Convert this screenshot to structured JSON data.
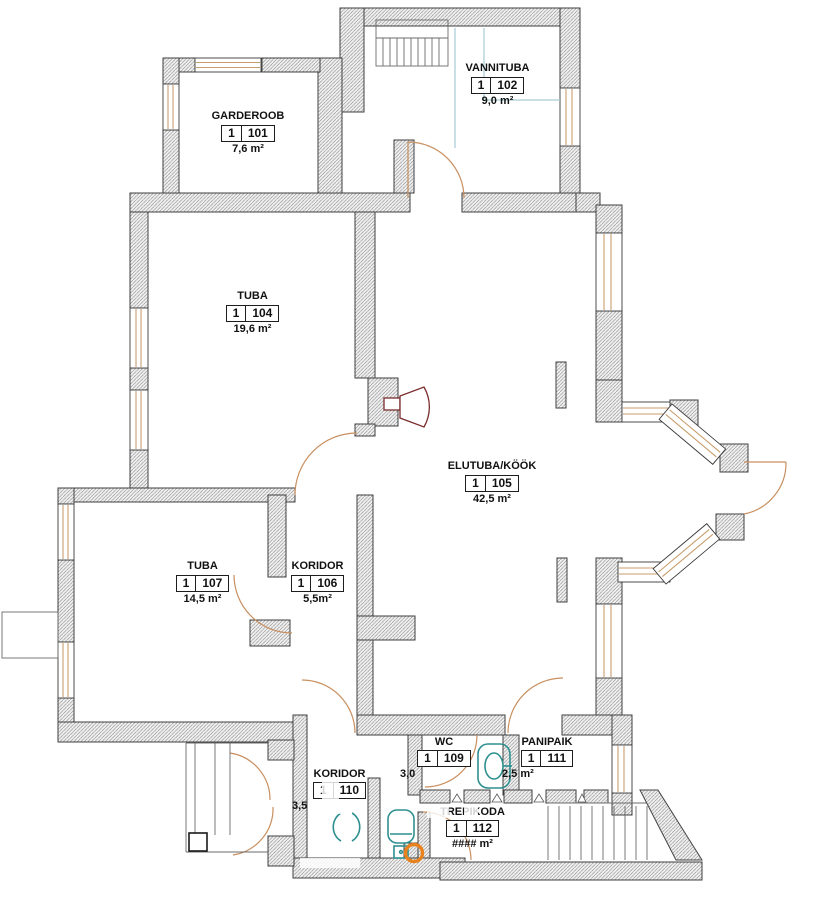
{
  "plan": {
    "title": "apartment-floor-plan",
    "rooms": [
      {
        "name": "GARDEROOB",
        "unit": "1",
        "number": "101",
        "area": "7,6 m²"
      },
      {
        "name": "VANNITUBA",
        "unit": "1",
        "number": "102",
        "area": "9,0 m²"
      },
      {
        "name": "TUBA",
        "unit": "1",
        "number": "104",
        "area": "19,6 m²"
      },
      {
        "name": "ELUTUBA/KÖÖK",
        "unit": "1",
        "number": "105",
        "area": "42,5 m²"
      },
      {
        "name": "KORIDOR",
        "unit": "1",
        "number": "106",
        "area": "5,5m²"
      },
      {
        "name": "TUBA",
        "unit": "1",
        "number": "107",
        "area": "14,5 m²"
      },
      {
        "name": "WC",
        "unit": "1",
        "number": "109",
        "area": "3,0"
      },
      {
        "name": "KORIDOR",
        "unit": "1",
        "number": "110",
        "area": "3,5"
      },
      {
        "name": "PANIPAIK",
        "unit": "1",
        "number": "111",
        "area": "2,5 m²"
      },
      {
        "name": "TREPIKODA",
        "unit": "1",
        "number": "112",
        "area": "#### m²"
      }
    ],
    "fixtures": [
      "stairs-icon",
      "toilet-icon",
      "sink-icon",
      "basin-icon",
      "fireplace-icon",
      "door-arc-icon",
      "window-icon"
    ],
    "colors": {
      "wall_outline": "#3f3f3f",
      "wall_hatch": "#9a9a9a",
      "window_frame": "#c99e6e",
      "door_swing": "#c98f5f",
      "plumbing_teal": "#2e8f8f",
      "accent_orange": "#e8821e",
      "fireplace_maroon": "#7a2e2e",
      "bath_guide_cyan": "#a8ccd4"
    }
  }
}
